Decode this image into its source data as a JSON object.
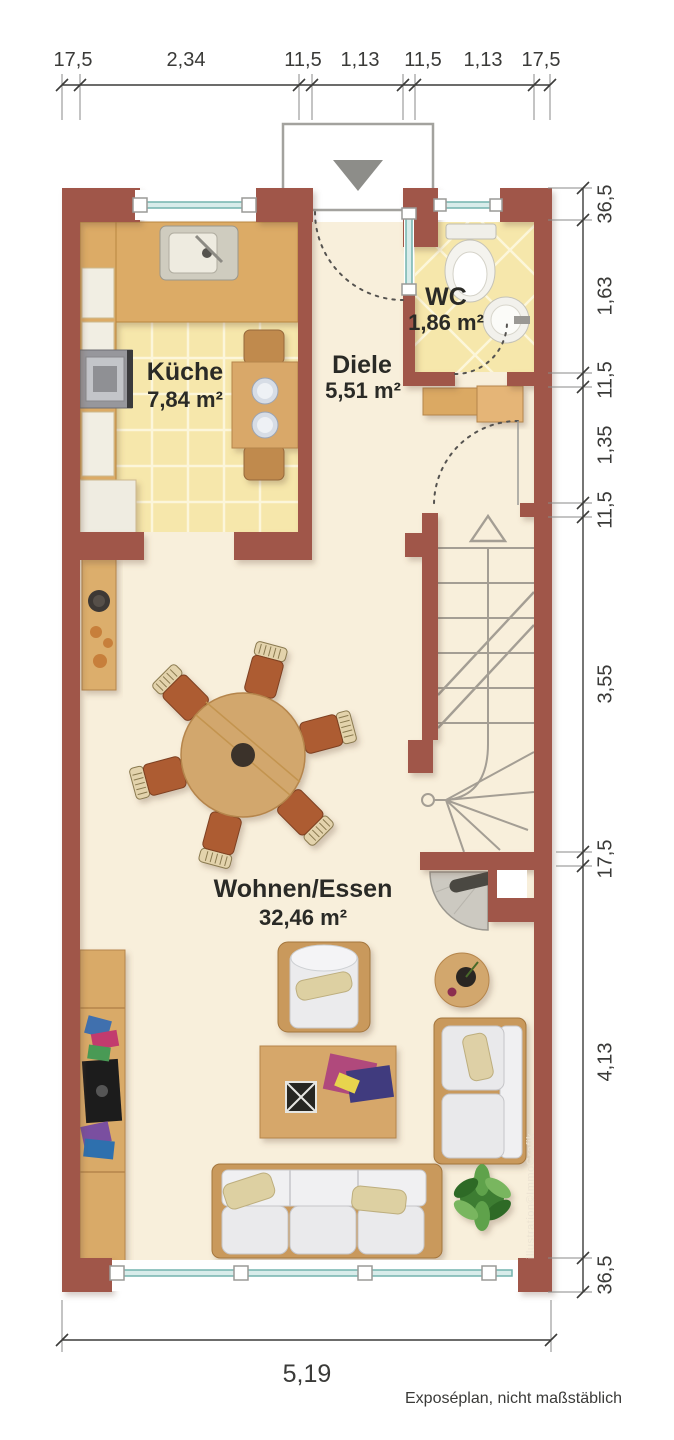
{
  "rooms": [
    {
      "name": "Küche",
      "area": "7,84 m²"
    },
    {
      "name": "Diele",
      "area": "5,51 m²"
    },
    {
      "name": "WC",
      "area": "1,86 m²"
    },
    {
      "name": "Wohnen/Essen",
      "area": "32,46 m²"
    }
  ],
  "dimensions": {
    "top": [
      "17,5",
      "2,34",
      "11,5",
      "1,13",
      "11,5",
      "1,13",
      "17,5"
    ],
    "right": [
      "36,5",
      "1,63",
      "11,5",
      "1,35",
      "11,5",
      "3,55",
      "17,5",
      "4,13",
      "36,5"
    ],
    "bottom_total": "5,19"
  },
  "watermark": "illustration©ImmoGrafik",
  "footer": "Exposéplan, nicht maßstäblich",
  "colors": {
    "wall": "#a0574a",
    "floor": "#f8efdb",
    "tile": "#f6e7ab",
    "wood": "#dcab66",
    "glass_fill": "#d8ecea",
    "glass_line": "#74b3ae",
    "dim_line": "#3c3c3a"
  }
}
